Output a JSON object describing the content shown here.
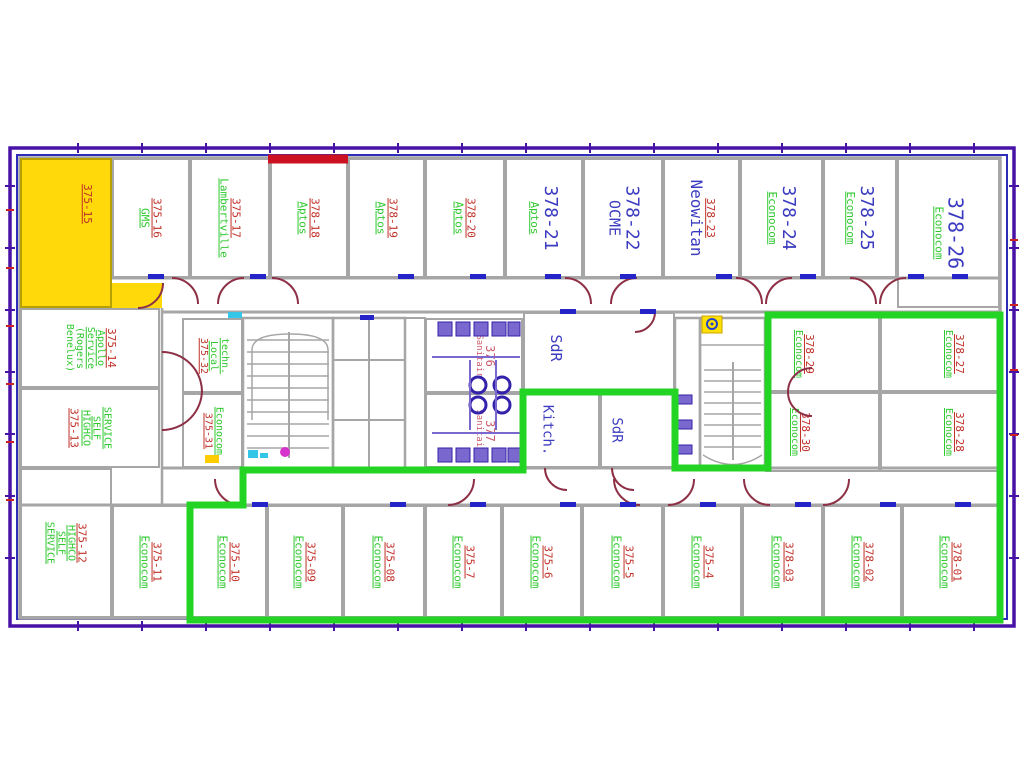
{
  "title": "Floor plan — levels 375 / 378 occupancy drawing",
  "colors": {
    "red": "#c03028",
    "green": "#2fc82f",
    "blue": "#3b3bc0",
    "pink": "#cd5f6e",
    "purple": "#7b68cf",
    "yellow_fill": "#ffd90a",
    "green_boundary": "#24d424",
    "red_wall": "#cc1122",
    "wall_gray": "#a6a6a6",
    "border_outer": "#4812a6",
    "border_inner": "#2d2dba",
    "door_arc": "#8d2f45",
    "threshold_blue": "#2424c8"
  },
  "overlays": {
    "green_boundary_path": "M190,505 L243,505 L243,470 L523,470 L523,392 L675,392 L675,468 L768,468 L768,315 L1000,315 L1000,620 L190,620 Z",
    "red_wall_path": "M268,159 H348"
  },
  "markers": {
    "stair_marker_glyph": "◉"
  },
  "rooms": [
    {
      "id": "375-15",
      "x": 20,
      "y": 158,
      "w": 92,
      "h": 150,
      "fill": "#ffd90a",
      "lx": 74,
      "ly": 30,
      "lines": [
        {
          "t": "375-15",
          "c": "red",
          "u": 1
        }
      ]
    },
    {
      "id": "375-15b",
      "x": 112,
      "y": 283,
      "w": 50,
      "h": 25,
      "fill": "#ffd90a",
      "lines": []
    },
    {
      "id": "375-16",
      "x": 112,
      "y": 158,
      "w": 78,
      "h": 120,
      "lines": [
        {
          "t": "375-16",
          "c": "red",
          "u": 1
        },
        {
          "t": "GMS",
          "c": "green",
          "u": 1
        }
      ]
    },
    {
      "id": "375-17",
      "x": 190,
      "y": 158,
      "w": 80,
      "h": 120,
      "lines": [
        {
          "t": "375-17",
          "c": "red",
          "u": 1
        },
        {
          "t": "Lambertville",
          "c": "green",
          "u": 1
        }
      ]
    },
    {
      "id": "378-18",
      "x": 270,
      "y": 158,
      "w": 78,
      "h": 120,
      "lines": [
        {
          "t": "378-18",
          "c": "red",
          "u": 1
        },
        {
          "t": "Aptos",
          "c": "green",
          "u": 1
        }
      ]
    },
    {
      "id": "378-19",
      "x": 348,
      "y": 158,
      "w": 77,
      "h": 120,
      "lines": [
        {
          "t": "378-19",
          "c": "red",
          "u": 1
        },
        {
          "t": "Aptos",
          "c": "green",
          "u": 1
        }
      ]
    },
    {
      "id": "378-20",
      "x": 425,
      "y": 158,
      "w": 80,
      "h": 120,
      "lines": [
        {
          "t": "378-20",
          "c": "red",
          "u": 1
        },
        {
          "t": "Aptos",
          "c": "green",
          "u": 1
        }
      ]
    },
    {
      "id": "378-21",
      "x": 505,
      "y": 158,
      "w": 78,
      "h": 120,
      "lines": [
        {
          "t": "378-21",
          "c": "blue",
          "s": 18
        },
        {
          "t": "Aptos",
          "c": "green",
          "u": 1
        }
      ]
    },
    {
      "id": "378-22",
      "x": 583,
      "y": 158,
      "w": 80,
      "h": 120,
      "lines": [
        {
          "t": "378-22",
          "c": "blue",
          "s": 18
        },
        {
          "t": "OCME",
          "c": "blue",
          "s": 15
        }
      ]
    },
    {
      "id": "378-23",
      "x": 663,
      "y": 158,
      "w": 77,
      "h": 120,
      "lines": [
        {
          "t": "378-23",
          "c": "red",
          "u": 1
        },
        {
          "t": "Neowitan",
          "c": "blue",
          "s": 16
        }
      ]
    },
    {
      "id": "378-24",
      "x": 740,
      "y": 158,
      "w": 83,
      "h": 120,
      "lines": [
        {
          "t": "378-24",
          "c": "blue",
          "s": 18
        },
        {
          "t": "Econocom",
          "c": "green",
          "u": 1
        }
      ]
    },
    {
      "id": "378-25",
      "x": 823,
      "y": 158,
      "w": 74,
      "h": 120,
      "lines": [
        {
          "t": "378-25",
          "c": "blue",
          "s": 18
        },
        {
          "t": "Econocom",
          "c": "green",
          "u": 1
        }
      ]
    },
    {
      "id": "378-26",
      "x": 897,
      "y": 158,
      "w": 103,
      "h": 150,
      "lines": [
        {
          "t": "378-26",
          "c": "blue",
          "s": 20
        },
        {
          "t": "Econocom",
          "c": "green",
          "u": 1
        }
      ]
    },
    {
      "id": "375-14",
      "x": 20,
      "y": 308,
      "w": 140,
      "h": 80,
      "lines": [
        {
          "t": "375-14",
          "c": "red",
          "u": 1
        },
        {
          "t": "Apollo",
          "c": "green",
          "u": 1,
          "s": 10
        },
        {
          "t": "Service",
          "c": "green",
          "u": 1,
          "s": 10
        },
        {
          "t": "(Rogers",
          "c": "green",
          "s": 10
        },
        {
          "t": "Benelux)",
          "c": "green",
          "s": 10
        }
      ]
    },
    {
      "id": "375-13",
      "x": 20,
      "y": 388,
      "w": 140,
      "h": 80,
      "lines": [
        {
          "t": "SERVICE",
          "c": "green",
          "u": 1,
          "s": 10
        },
        {
          "t": "SELF",
          "c": "green",
          "u": 1,
          "s": 10
        },
        {
          "t": "HIGHCO",
          "c": "green",
          "u": 1,
          "s": 10
        },
        {
          "t": "375-13",
          "c": "red",
          "u": 1
        }
      ]
    },
    {
      "id": "375-12",
      "x": 20,
      "y": 468,
      "w": 92,
      "h": 150,
      "lines": [
        {
          "t": "375-12",
          "c": "red",
          "u": 1
        },
        {
          "t": "HIGHCO",
          "c": "green",
          "u": 1,
          "s": 10
        },
        {
          "t": "SELF",
          "c": "green",
          "u": 1,
          "s": 10
        },
        {
          "t": "SERVICE",
          "c": "green",
          "u": 1,
          "s": 10
        }
      ]
    },
    {
      "id": "375-32",
      "x": 182,
      "y": 318,
      "w": 61,
      "h": 75,
      "lines": [
        {
          "t": "techn.",
          "c": "green",
          "u": 1,
          "s": 10
        },
        {
          "t": "Local",
          "c": "green",
          "u": 1,
          "s": 10
        },
        {
          "t": "375-32",
          "c": "red",
          "u": 1,
          "s": 10
        }
      ]
    },
    {
      "id": "375-31",
      "x": 182,
      "y": 393,
      "w": 61,
      "h": 75,
      "lines": [
        {
          "t": "Econocom",
          "c": "green",
          "u": 1,
          "s": 10
        },
        {
          "t": "375-31",
          "c": "red",
          "u": 1,
          "s": 10
        }
      ]
    },
    {
      "id": "376",
      "x": 425,
      "y": 318,
      "w": 98,
      "h": 75,
      "lx": 62,
      "lines": [
        {
          "t": "376",
          "c": "pink",
          "s": 12
        },
        {
          "t": "Sanitair",
          "c": "pink",
          "s": 9
        }
      ]
    },
    {
      "id": "377",
      "x": 425,
      "y": 393,
      "w": 98,
      "h": 75,
      "lx": 62,
      "lines": [
        {
          "t": "377",
          "c": "pink",
          "s": 12
        },
        {
          "t": "Sanitair",
          "c": "pink",
          "s": 9
        }
      ]
    },
    {
      "id": "sdr-1",
      "x": 523,
      "y": 312,
      "w": 152,
      "h": 80,
      "lx": 20,
      "ly": 45,
      "lines": [
        {
          "t": "SdR",
          "c": "blue",
          "s": 15
        }
      ]
    },
    {
      "id": "kitch",
      "x": 523,
      "y": 392,
      "w": 77,
      "h": 76,
      "lx": 30,
      "lines": [
        {
          "t": "Kitch.",
          "c": "blue",
          "s": 14
        }
      ]
    },
    {
      "id": "sdr-2",
      "x": 600,
      "y": 392,
      "w": 75,
      "h": 76,
      "lx": 20,
      "lines": [
        {
          "t": "SdR",
          "c": "blue",
          "s": 14
        }
      ]
    },
    {
      "id": "378-29",
      "x": 765,
      "y": 315,
      "w": 115,
      "h": 77,
      "lx": 33,
      "lines": [
        {
          "t": "378-29",
          "c": "red",
          "u": 1
        },
        {
          "t": "Econocom",
          "c": "green",
          "u": 1,
          "s": 10
        }
      ]
    },
    {
      "id": "378-30",
      "x": 765,
      "y": 392,
      "w": 115,
      "h": 80,
      "lx": 30,
      "lines": [
        {
          "t": "378-30",
          "c": "red",
          "u": 1
        },
        {
          "t": "Econocom",
          "c": "green",
          "u": 1,
          "s": 10
        }
      ]
    },
    {
      "id": "378-27",
      "x": 880,
      "y": 315,
      "w": 120,
      "h": 77,
      "lx": 62,
      "lines": [
        {
          "t": "378-27",
          "c": "red",
          "u": 1
        },
        {
          "t": "Econocom",
          "c": "green",
          "u": 1,
          "s": 10
        }
      ]
    },
    {
      "id": "378-28",
      "x": 880,
      "y": 392,
      "w": 120,
      "h": 80,
      "lx": 62,
      "lines": [
        {
          "t": "378-28",
          "c": "red",
          "u": 1
        },
        {
          "t": "Econocom",
          "c": "green",
          "u": 1,
          "s": 10
        }
      ]
    },
    {
      "id": "375-11",
      "x": 112,
      "y": 505,
      "w": 78,
      "h": 113,
      "lines": [
        {
          "t": "375-11",
          "c": "red",
          "u": 1
        },
        {
          "t": "Econocom",
          "c": "green",
          "u": 1
        }
      ]
    },
    {
      "id": "375-10",
      "x": 190,
      "y": 505,
      "w": 77,
      "h": 113,
      "lines": [
        {
          "t": "375-10",
          "c": "red",
          "u": 1
        },
        {
          "t": "Econocom",
          "c": "green",
          "u": 1
        }
      ]
    },
    {
      "id": "375-09",
      "x": 267,
      "y": 505,
      "w": 76,
      "h": 113,
      "lines": [
        {
          "t": "375-09",
          "c": "red",
          "u": 1
        },
        {
          "t": "Econocom",
          "c": "green",
          "u": 1
        }
      ]
    },
    {
      "id": "375-08",
      "x": 343,
      "y": 505,
      "w": 82,
      "h": 113,
      "lines": [
        {
          "t": "375-08",
          "c": "red",
          "u": 1
        },
        {
          "t": "Econocom",
          "c": "green",
          "u": 1
        }
      ]
    },
    {
      "id": "375-7",
      "x": 425,
      "y": 505,
      "w": 77,
      "h": 113,
      "lines": [
        {
          "t": "375-7",
          "c": "red",
          "u": 1
        },
        {
          "t": "Econocom",
          "c": "green",
          "u": 1
        }
      ]
    },
    {
      "id": "375-6",
      "x": 502,
      "y": 505,
      "w": 80,
      "h": 113,
      "lines": [
        {
          "t": "375-6",
          "c": "red",
          "u": 1
        },
        {
          "t": "Econocom",
          "c": "green",
          "u": 1
        }
      ]
    },
    {
      "id": "375-5",
      "x": 582,
      "y": 505,
      "w": 81,
      "h": 113,
      "lines": [
        {
          "t": "375-5",
          "c": "red",
          "u": 1
        },
        {
          "t": "Econocom",
          "c": "green",
          "u": 1
        }
      ]
    },
    {
      "id": "375-4",
      "x": 663,
      "y": 505,
      "w": 79,
      "h": 113,
      "lines": [
        {
          "t": "375-4",
          "c": "red",
          "u": 1
        },
        {
          "t": "Econocom",
          "c": "green",
          "u": 1
        }
      ]
    },
    {
      "id": "378-03",
      "x": 742,
      "y": 505,
      "w": 81,
      "h": 113,
      "lines": [
        {
          "t": "378-03",
          "c": "red",
          "u": 1
        },
        {
          "t": "Econocom",
          "c": "green",
          "u": 1
        }
      ]
    },
    {
      "id": "378-02",
      "x": 823,
      "y": 505,
      "w": 79,
      "h": 113,
      "lines": [
        {
          "t": "378-02",
          "c": "red",
          "u": 1
        },
        {
          "t": "Econocom",
          "c": "green",
          "u": 1
        }
      ]
    },
    {
      "id": "378-01",
      "x": 902,
      "y": 505,
      "w": 98,
      "h": 113,
      "lines": [
        {
          "t": "378-01",
          "c": "red",
          "u": 1
        },
        {
          "t": "Econocom",
          "c": "green",
          "u": 1
        }
      ]
    }
  ]
}
